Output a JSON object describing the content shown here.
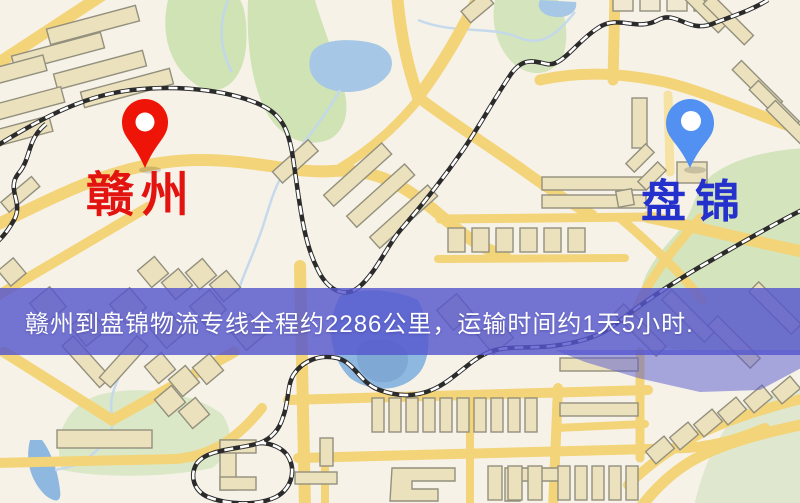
{
  "map": {
    "origin": {
      "label": "赣州",
      "pin": "red-map-pin",
      "pin_color": "#ee1407",
      "label_color": "#e31310"
    },
    "destination": {
      "label": "盘锦",
      "pin": "blue-map-pin",
      "pin_color": "#5290f2",
      "label_color": "#2531cd"
    },
    "banner": {
      "text": "赣州到盘锦物流专线全程约2286公里，运输时间约1天5小时.",
      "background_color": "#5657cd",
      "text_color": "#ffffff",
      "distance_km": "2286",
      "duration": "1天5小时"
    },
    "style_colors": {
      "base": "#f7f2e8",
      "road": "#f3d478",
      "railway": "#2b2b2b",
      "water": "#9fc2e4",
      "park": "#cfe3b4",
      "building": "#ece1bd",
      "highlight_overlay": "#5657cd"
    }
  }
}
